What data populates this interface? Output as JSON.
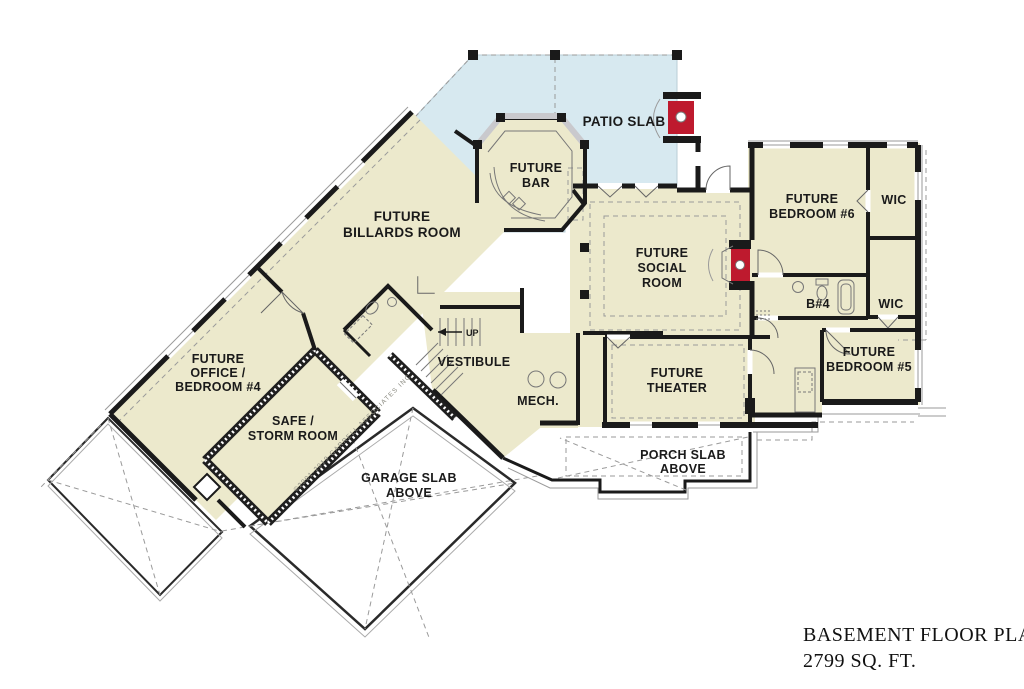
{
  "title": {
    "line1": "BASEMENT FLOOR PLAN",
    "line2": "2799 SQ. FT."
  },
  "watermark": "©2001-2019 GARRELL ASSOCIATES INC.",
  "colors": {
    "floor_fill": "#ECE9CC",
    "patio_fill": "#D7E9F0",
    "wall": "#1A1A1A",
    "fireplace_red": "#BE1A2E",
    "detail_gray": "#9A9A9A"
  },
  "rooms": {
    "patio": {
      "label": "PATIO SLAB"
    },
    "bar": {
      "lines": [
        "FUTURE",
        "BAR"
      ]
    },
    "billards": {
      "lines": [
        "FUTURE",
        "BILLARDS ROOM"
      ]
    },
    "social": {
      "lines": [
        "FUTURE",
        "SOCIAL",
        "ROOM"
      ]
    },
    "bedroom6": {
      "lines": [
        "FUTURE",
        "BEDROOM #6"
      ]
    },
    "wic1": {
      "label": "WIC"
    },
    "bath4": {
      "label": "B#4"
    },
    "wic2": {
      "label": "WIC"
    },
    "bedroom5": {
      "lines": [
        "FUTURE",
        "BEDROOM #5"
      ]
    },
    "office": {
      "lines": [
        "FUTURE",
        "OFFICE /",
        "BEDROOM #4"
      ]
    },
    "safe": {
      "lines": [
        "SAFE /",
        "STORM ROOM"
      ]
    },
    "vestibule": {
      "label": "VESTIBULE"
    },
    "mech": {
      "label": "MECH."
    },
    "theater": {
      "lines": [
        "FUTURE",
        "THEATER"
      ]
    },
    "garage": {
      "lines": [
        "GARAGE SLAB",
        "ABOVE"
      ]
    },
    "porch": {
      "lines": [
        "PORCH SLAB",
        "ABOVE"
      ]
    },
    "stairs": {
      "label": "UP"
    }
  }
}
